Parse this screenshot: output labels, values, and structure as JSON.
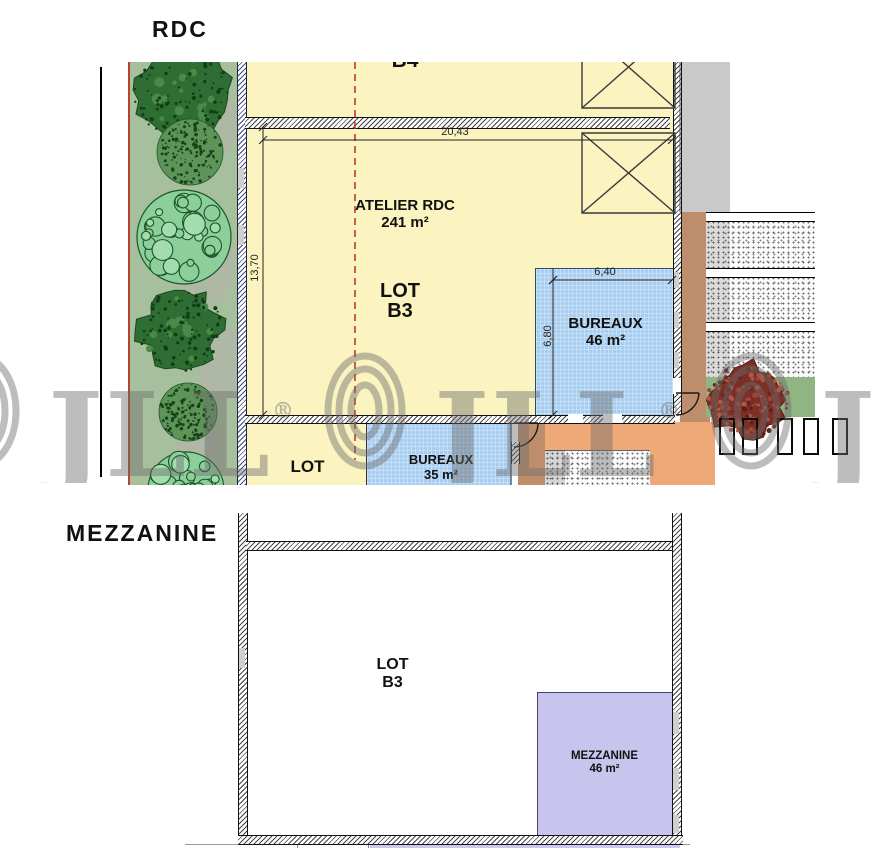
{
  "rdc": {
    "title": "RDC",
    "adjacent_lot_label": "B4",
    "atelier": {
      "name": "ATELIER RDC",
      "area": "241 m²"
    },
    "lot": {
      "label": "LOT",
      "number": "B3"
    },
    "bureaux_46": {
      "name": "BUREAUX",
      "area": "46 m²"
    },
    "bureaux_35": {
      "name": "BUREAUX",
      "area": "35 m²"
    },
    "lot_lower_label": "LOT",
    "dimensions": {
      "width_total": "20,43",
      "height_total": "13,70",
      "bureaux_width": "6,40",
      "bureaux_height": "6,80"
    }
  },
  "mezzanine": {
    "title": "MEZZANINE",
    "lot": {
      "label": "LOT",
      "number": "B3"
    },
    "room": {
      "name": "MEZZANINE",
      "area": "46 m²"
    }
  },
  "watermark": {
    "text": "JLL",
    "registered": "®"
  },
  "colors": {
    "yellow": "#FBF4C1",
    "blue": "#A7CDF1",
    "purple": "#C7C4ED",
    "lavender": "#CBC8EF",
    "green_strip": "#A6BF9C",
    "green_band": "#8FB583",
    "gray_zone": "#C9C9C9",
    "brown": "#BE8E6C",
    "orange": "#EFA878",
    "red_line": "#B5442C",
    "dashed_red": "#C03A2B",
    "hatch_blue": "#3A4A8C",
    "text": "#111111"
  }
}
